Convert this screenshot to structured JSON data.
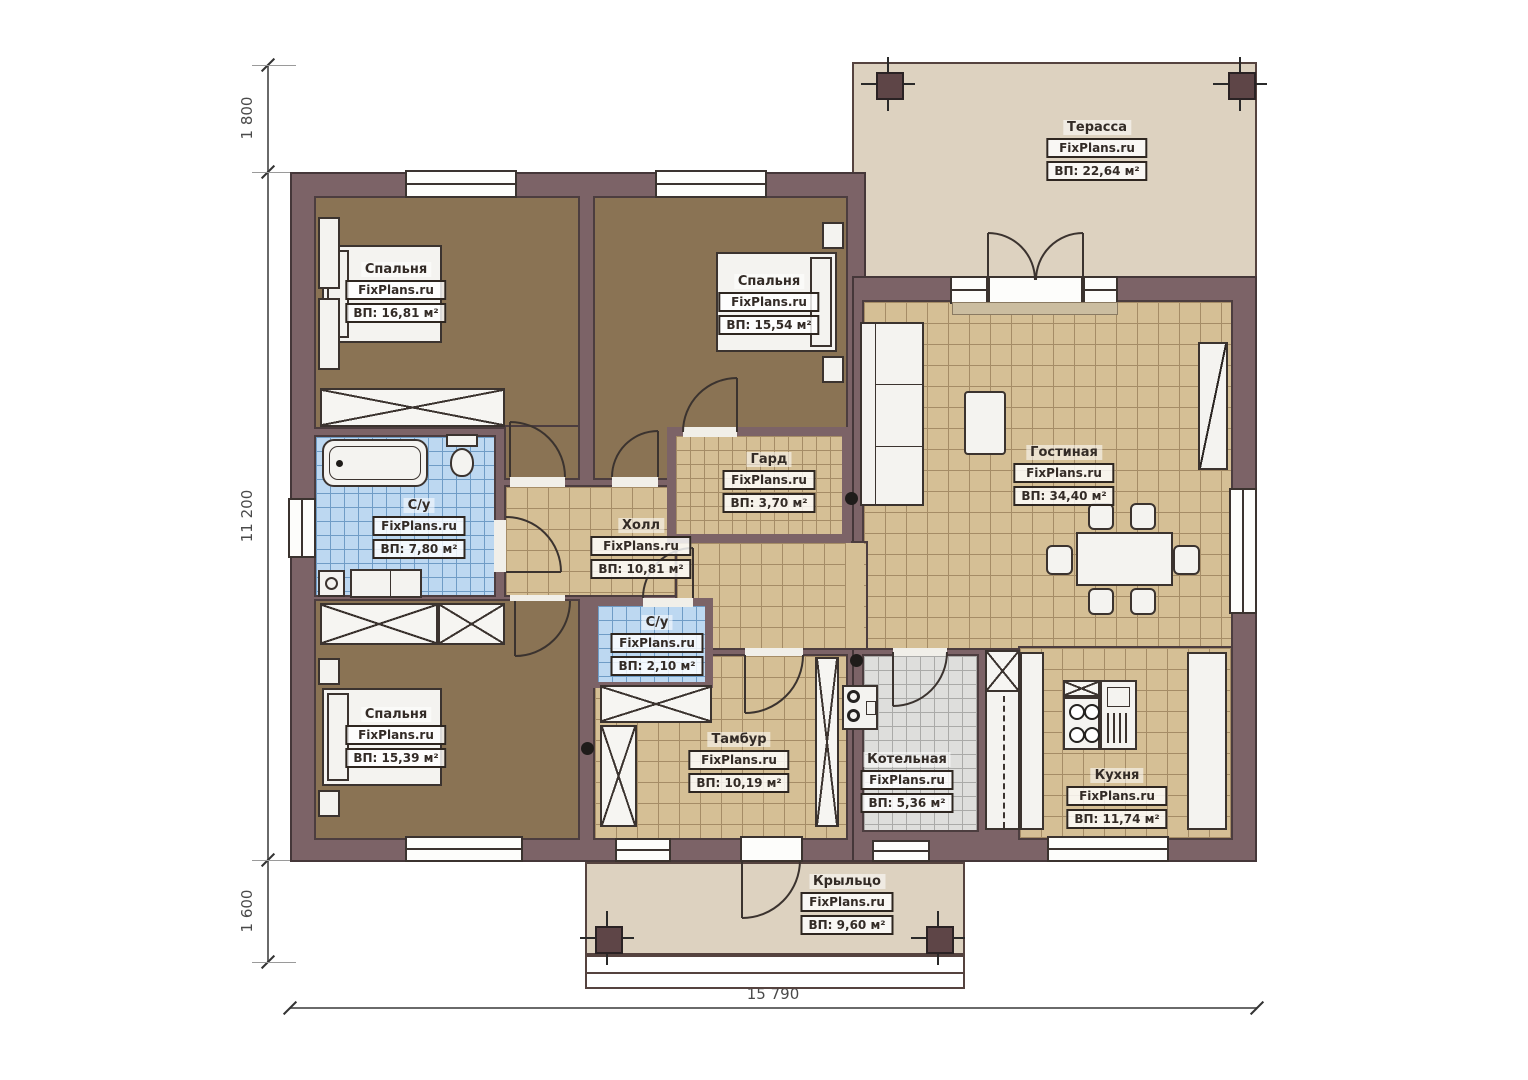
{
  "plan_title": "Floor plan",
  "brand": "FixPlans.ru",
  "rooms": [
    {
      "id": "terrace",
      "name": "Терасса",
      "brand": "FixPlans.ru",
      "area": "ВП: 22,64 м²"
    },
    {
      "id": "bedroom-top-left",
      "name": "Спальня",
      "brand": "FixPlans.ru",
      "area": "ВП: 16,81 м²"
    },
    {
      "id": "bedroom-top-middle",
      "name": "Спальня",
      "brand": "FixPlans.ru",
      "area": "ВП: 15,54 м²"
    },
    {
      "id": "wardrobe",
      "name": "Гард",
      "brand": "FixPlans.ru",
      "area": "ВП: 3,70 м²"
    },
    {
      "id": "living-room",
      "name": "Гостиная",
      "brand": "FixPlans.ru",
      "area": "ВП: 34,40 м²"
    },
    {
      "id": "bathroom-main",
      "name": "С/у",
      "brand": "FixPlans.ru",
      "area": "ВП: 7,80 м²"
    },
    {
      "id": "hall",
      "name": "Холл",
      "brand": "FixPlans.ru",
      "area": "ВП: 10,81 м²"
    },
    {
      "id": "bathroom-small",
      "name": "С/у",
      "brand": "FixPlans.ru",
      "area": "ВП: 2,10 м²"
    },
    {
      "id": "bedroom-bottom-left",
      "name": "Спальня",
      "brand": "FixPlans.ru",
      "area": "ВП: 15,39 м²"
    },
    {
      "id": "vestibule",
      "name": "Тамбур",
      "brand": "FixPlans.ru",
      "area": "ВП: 10,19 м²"
    },
    {
      "id": "boiler-room",
      "name": "Котельная",
      "brand": "FixPlans.ru",
      "area": "ВП: 5,36 м²"
    },
    {
      "id": "kitchen",
      "name": "Кухня",
      "brand": "FixPlans.ru",
      "area": "ВП: 11,74 м²"
    },
    {
      "id": "porch",
      "name": "Крыльцо",
      "brand": "FixPlans.ru",
      "area": "ВП: 9,60 м²"
    }
  ],
  "dimensions": {
    "left_top": "1 800",
    "left_middle": "11 200",
    "left_bottom": "1 600",
    "bottom": "15 790"
  },
  "colors": {
    "wall": "#7c6367",
    "floor_wood": "#8a7354",
    "tile_beige": "#d5bf95",
    "tile_blue": "#bdd8f1",
    "tile_gray": "#dededc",
    "outdoor": "#ddd2c0"
  }
}
